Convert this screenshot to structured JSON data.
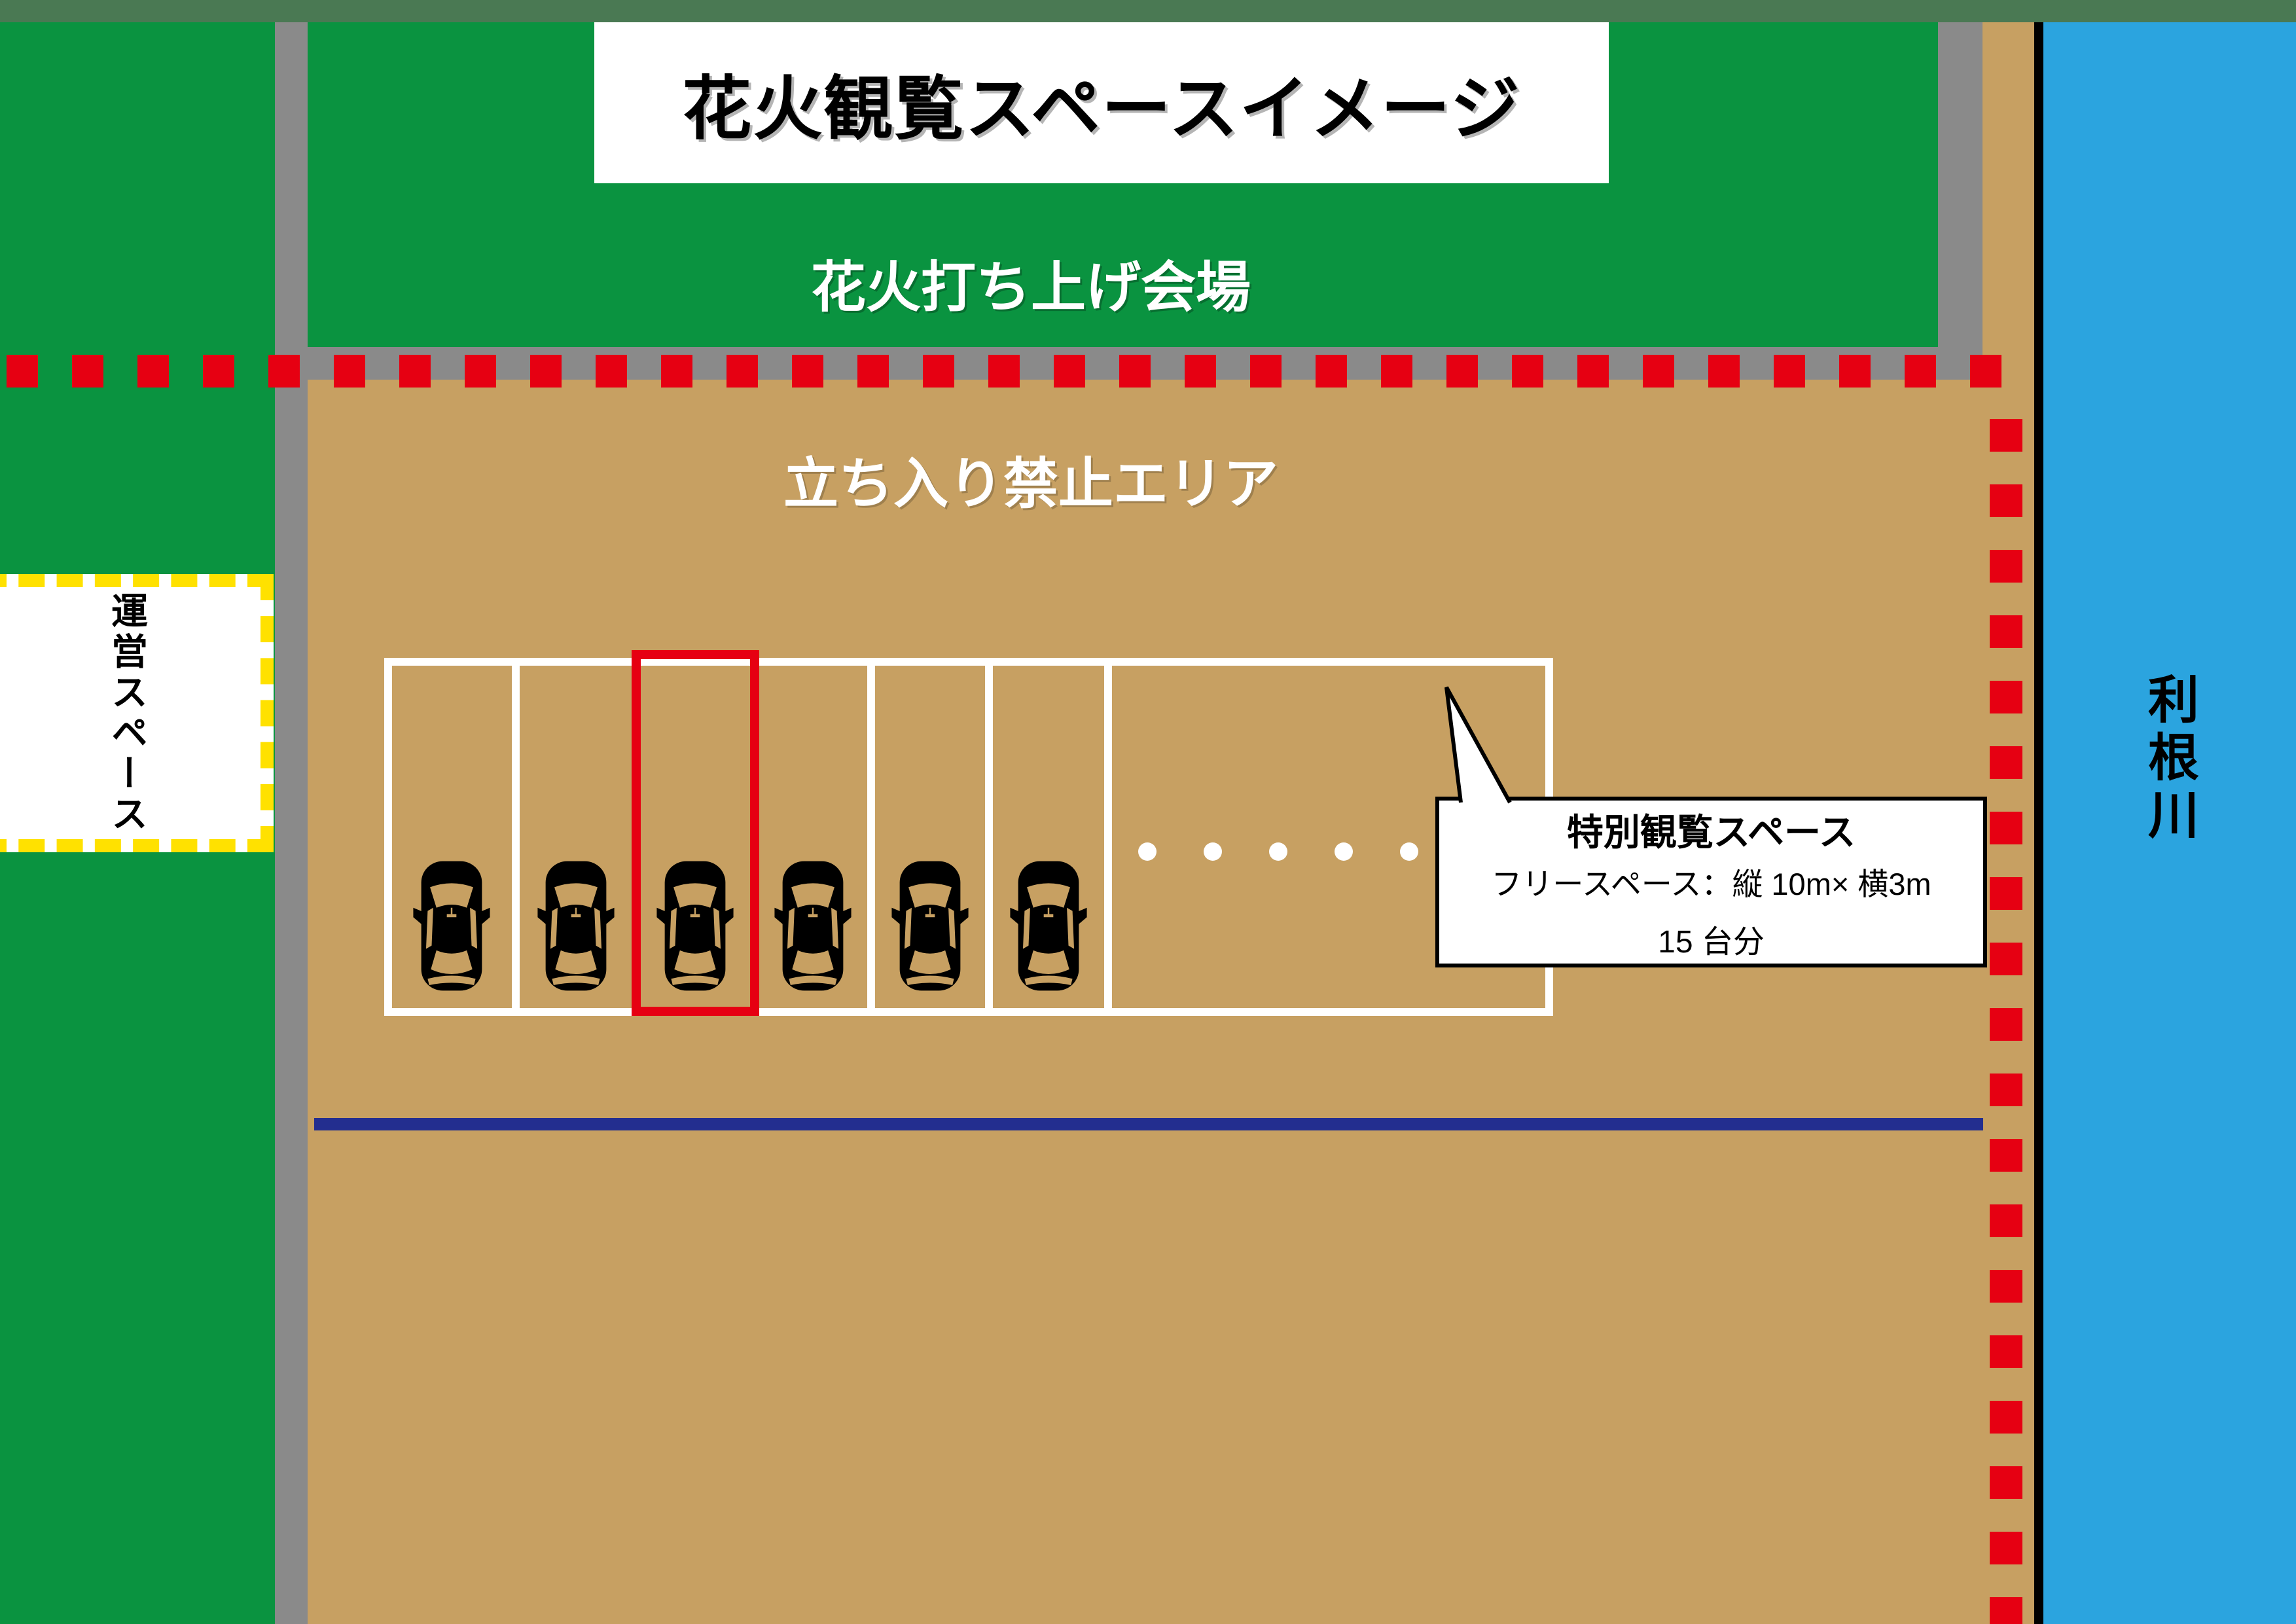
{
  "title": "花火観覧スペースイメージ",
  "areas": {
    "launch_venue_label": "花火打ち上げ会場",
    "no_entry_label": "立ち入り禁止エリア",
    "operations_label": "運営スペース",
    "river_label": "利根川"
  },
  "callout": {
    "heading": "特別観覧スペース",
    "detail_line": "フリースペース：縦 10m× 横3m",
    "capacity_line": "15 台分"
  },
  "parking": {
    "car_count": 6,
    "continuation_dot_count": 5,
    "highlighted_stall_index": 3
  },
  "boundary": {
    "horizontal_dash_count": 31,
    "vertical_dash_count": 19
  },
  "colors": {
    "grass_green": "#0a9340",
    "top_strip_green": "#4a7953",
    "road_gray": "#8a8a8a",
    "ground_tan": "#c7a062",
    "warning_red": "#e60012",
    "ops_border_yellow": "#ffe100",
    "river_blue": "#2ba4df",
    "navy_line": "#232e8f",
    "stall_line_white": "#ffffff"
  }
}
